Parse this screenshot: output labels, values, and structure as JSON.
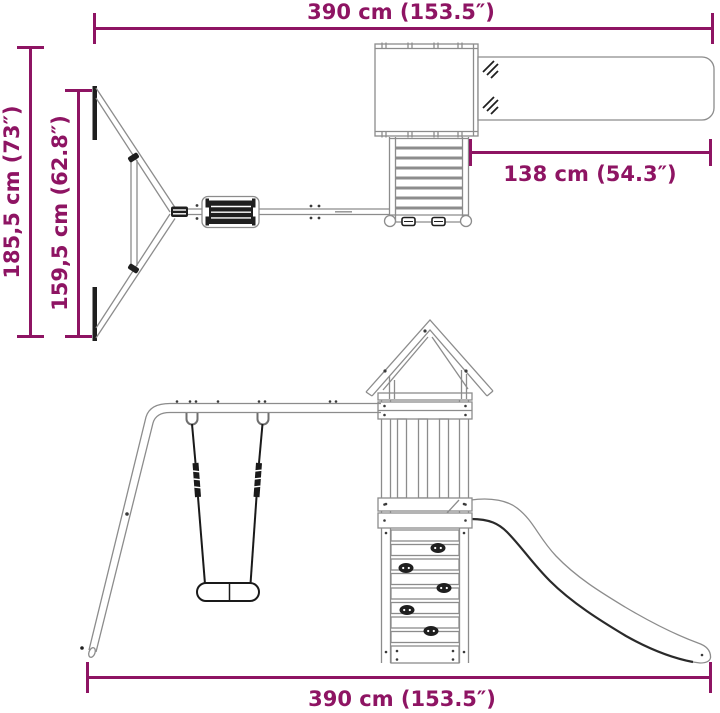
{
  "diagram": {
    "colors": {
      "dimension": "#8e1463",
      "outline": "#8c8c8c",
      "dark": "#1f1f1f"
    },
    "top_view": {
      "dim_width": "390 cm (153.5″)",
      "dim_depth_total": "185,5 cm (73″)",
      "dim_depth_swing": "159,5 cm (62.8″)",
      "dim_slide": "138 cm (54.3″)"
    },
    "front_view": {
      "dim_width": "390 cm (153.5″)"
    }
  }
}
